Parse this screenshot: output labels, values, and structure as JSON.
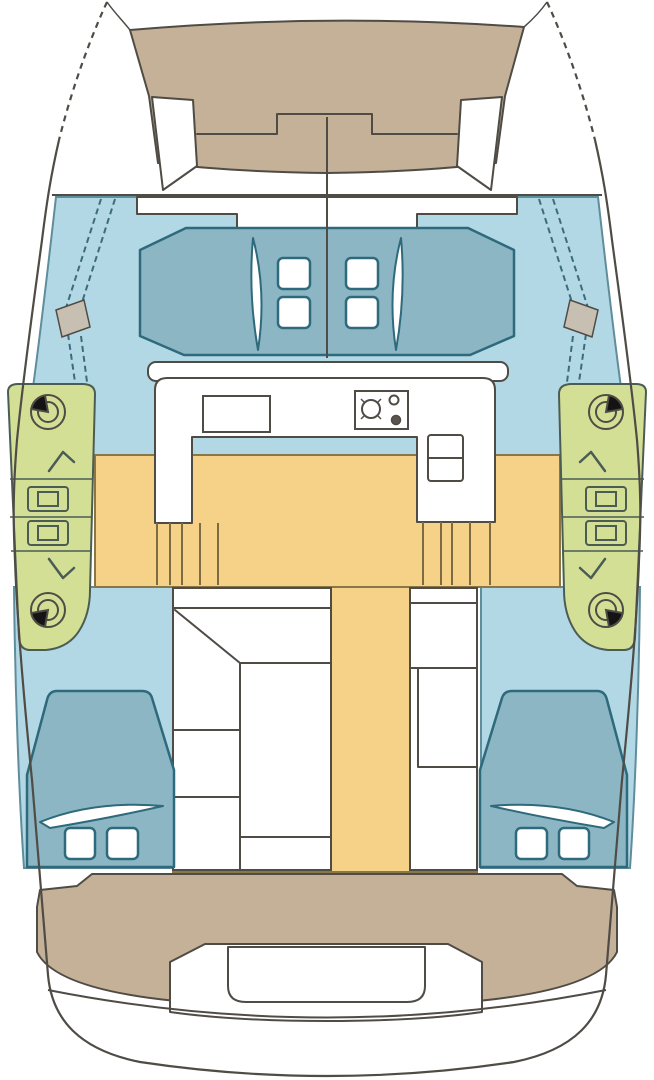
{
  "diagram": {
    "type": "boat-floor-plan",
    "subject": "catamaran deck and interior layout, top-down view",
    "view": "plan"
  },
  "canvas": {
    "width": 654,
    "height": 1080
  },
  "colors": {
    "page_bg": "#ffffff",
    "hull_white": "#ffffff",
    "white_fill": "#ffffff",
    "outline_dark": "#4f4b45",
    "deck_tan": "#c5b197",
    "interior_blue": "#b3d8e5",
    "blue_outline": "#5f8d9c",
    "cushion_teal": "#8cb6c3",
    "teal_outline": "#2e6a7c",
    "sidedeck_green": "#d4df96",
    "green_outline": "#4b5c55",
    "sole_yellow": "#f5d287",
    "sole_outline": "#8a7747",
    "hardware_black": "#141414",
    "chainplate_gray": "#c7c0b2",
    "track_brown": "#7d6b42",
    "shroud_line": "#3d6b7a"
  },
  "icons": {
    "winch": "winch-drum with black handle wedge",
    "clutch": "rope clutch rectangle",
    "cleat": "chevron fairlead",
    "stove": "two-burner cooktop",
    "sink": "double sink",
    "hatch": "deck hatch square"
  }
}
